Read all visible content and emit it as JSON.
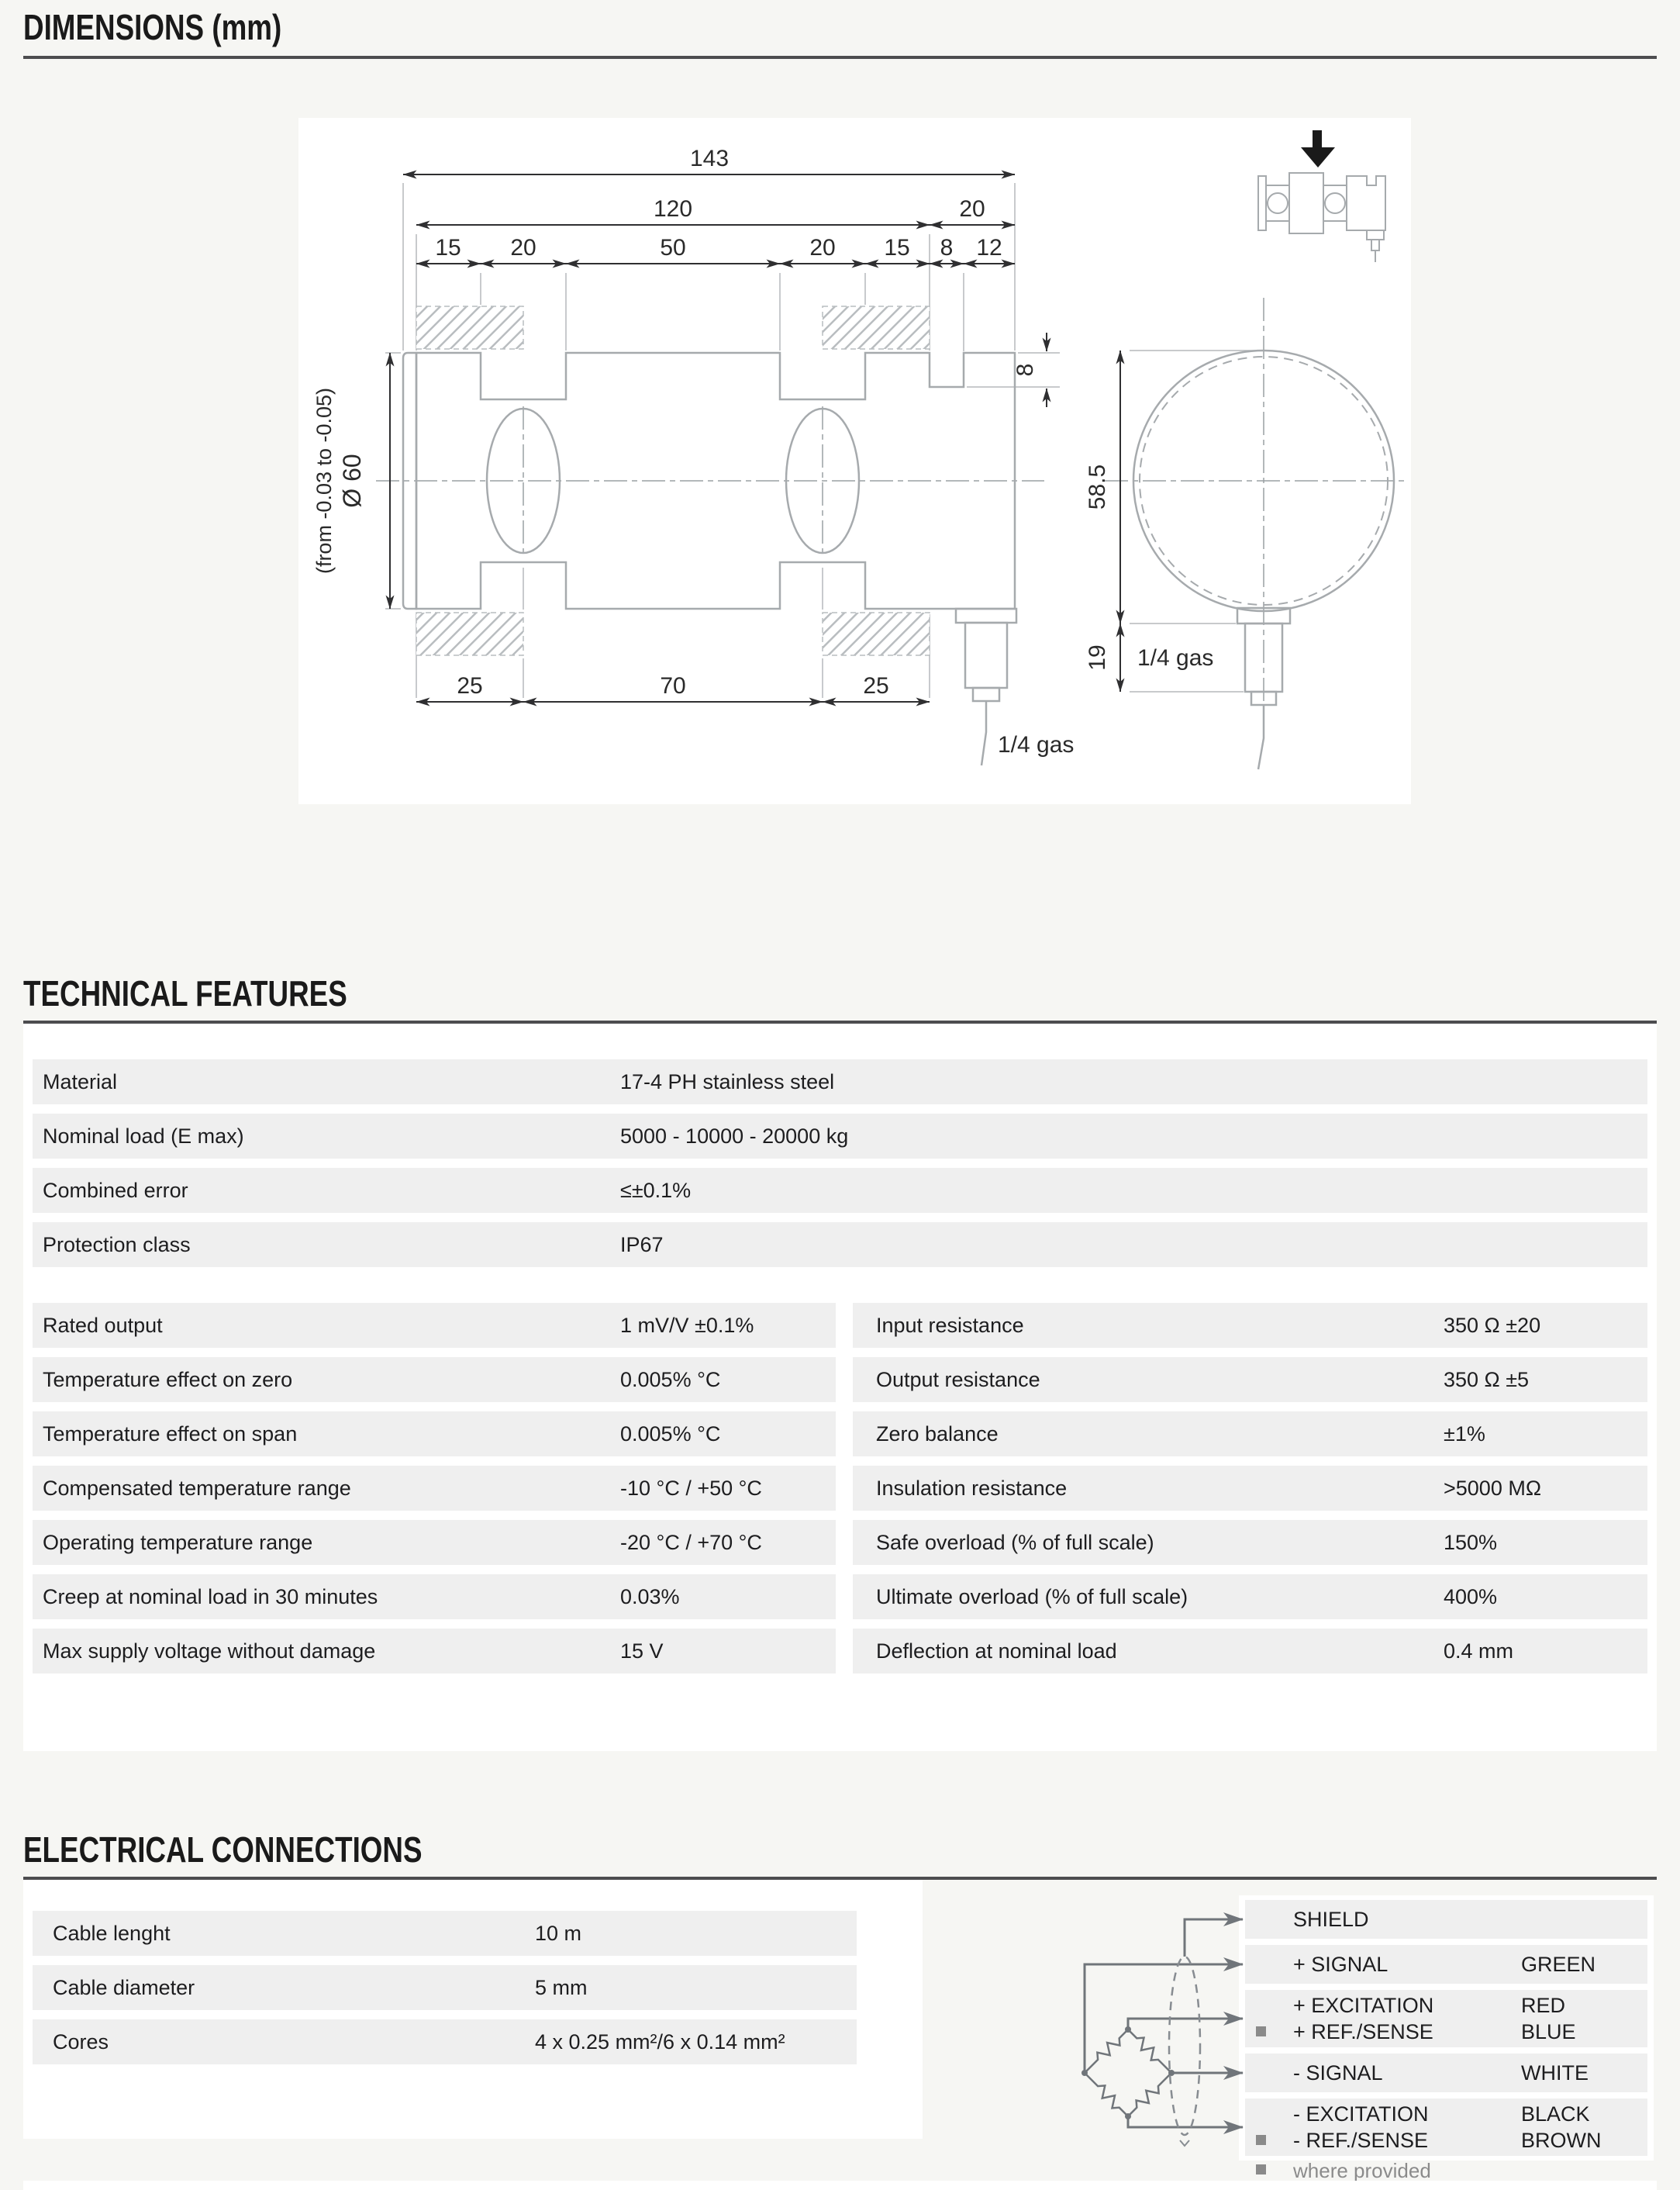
{
  "colors": {
    "page_bg": "#f6f6f3",
    "panel": "#ffffff",
    "row_bg": "#efefef",
    "rule": "#4d4d4f",
    "text": "#1d1d1f",
    "muted": "#8b8b8b",
    "drawing_outline": "#a6aaad",
    "dimension": "#2f2f31",
    "wire": "#70757a"
  },
  "dimensions_section": {
    "title": "DIMENSIONS (mm)",
    "drawing": {
      "total_length": "143",
      "upper_length": "120",
      "upper_end": "20",
      "seg_a": "15",
      "seg_b": "20",
      "seg_c": "50",
      "seg_d": "20",
      "seg_e": "15",
      "seg_f": "8",
      "seg_g": "12",
      "diameter": "Ø 60",
      "diameter_tol": "(from -0.03 to -0.05)",
      "notch_depth": "8",
      "side_width": "58.5",
      "connector_len": "19",
      "lower_a": "25",
      "lower_b": "70",
      "lower_c": "25",
      "thread_front": "1/4 gas",
      "thread_side": "1/4 gas"
    }
  },
  "technical_features": {
    "title": "TECHNICAL FEATURES",
    "general_rows": [
      {
        "label": "Material",
        "value": "17-4 PH stainless steel"
      },
      {
        "label": "Nominal load (E max)",
        "value": "5000 - 10000 - 20000 kg"
      },
      {
        "label": "Combined error",
        "value": "≤±0.1%"
      },
      {
        "label": "Protection class",
        "value": "IP67"
      }
    ],
    "left_rows": [
      {
        "label": "Rated output",
        "value": "1 mV/V ±0.1%"
      },
      {
        "label": "Temperature effect on zero",
        "value": "0.005% °C"
      },
      {
        "label": "Temperature effect on span",
        "value": "0.005% °C"
      },
      {
        "label": "Compensated temperature range",
        "value": "-10 °C / +50 °C"
      },
      {
        "label": "Operating temperature range",
        "value": "-20 °C / +70 °C"
      },
      {
        "label": "Creep at nominal load in 30 minutes",
        "value": "0.03%"
      },
      {
        "label": "Max supply voltage without damage",
        "value": "15 V"
      }
    ],
    "right_rows": [
      {
        "label": "Input resistance",
        "value": "350 Ω ±20"
      },
      {
        "label": "Output resistance",
        "value": "350 Ω ±5"
      },
      {
        "label": "Zero balance",
        "value": "±1%"
      },
      {
        "label": "Insulation resistance",
        "value": ">5000 MΩ"
      },
      {
        "label": "Safe overload (% of full scale)",
        "value": "150%"
      },
      {
        "label": "Ultimate overload (% of full scale)",
        "value": "400%"
      },
      {
        "label": "Deflection at nominal load",
        "value": "0.4 mm"
      }
    ]
  },
  "electrical_connections": {
    "title": "ELECTRICAL CONNECTIONS",
    "cable_rows": [
      {
        "label": "Cable lenght",
        "value": "10 m"
      },
      {
        "label": "Cable diameter",
        "value": "5 mm"
      },
      {
        "label": "Cores",
        "value": "4 x 0.25 mm²/6 x 0.14 mm²"
      }
    ],
    "wiring_table": {
      "row_shield": {
        "label": "SHIELD"
      },
      "row_pos_signal": {
        "label": "+ SIGNAL",
        "color": "GREEN"
      },
      "row_pos_excitation": {
        "label": "+ EXCITATION",
        "color": "RED"
      },
      "row_pos_ref": {
        "label": "+ REF./SENSE",
        "color": "BLUE"
      },
      "row_neg_signal": {
        "label": "- SIGNAL",
        "color": "WHITE"
      },
      "row_neg_excitation": {
        "label": "- EXCITATION",
        "color": "BLACK"
      },
      "row_neg_ref": {
        "label": "- REF./SENSE",
        "color": "BROWN"
      }
    },
    "footnote": "where provided"
  }
}
